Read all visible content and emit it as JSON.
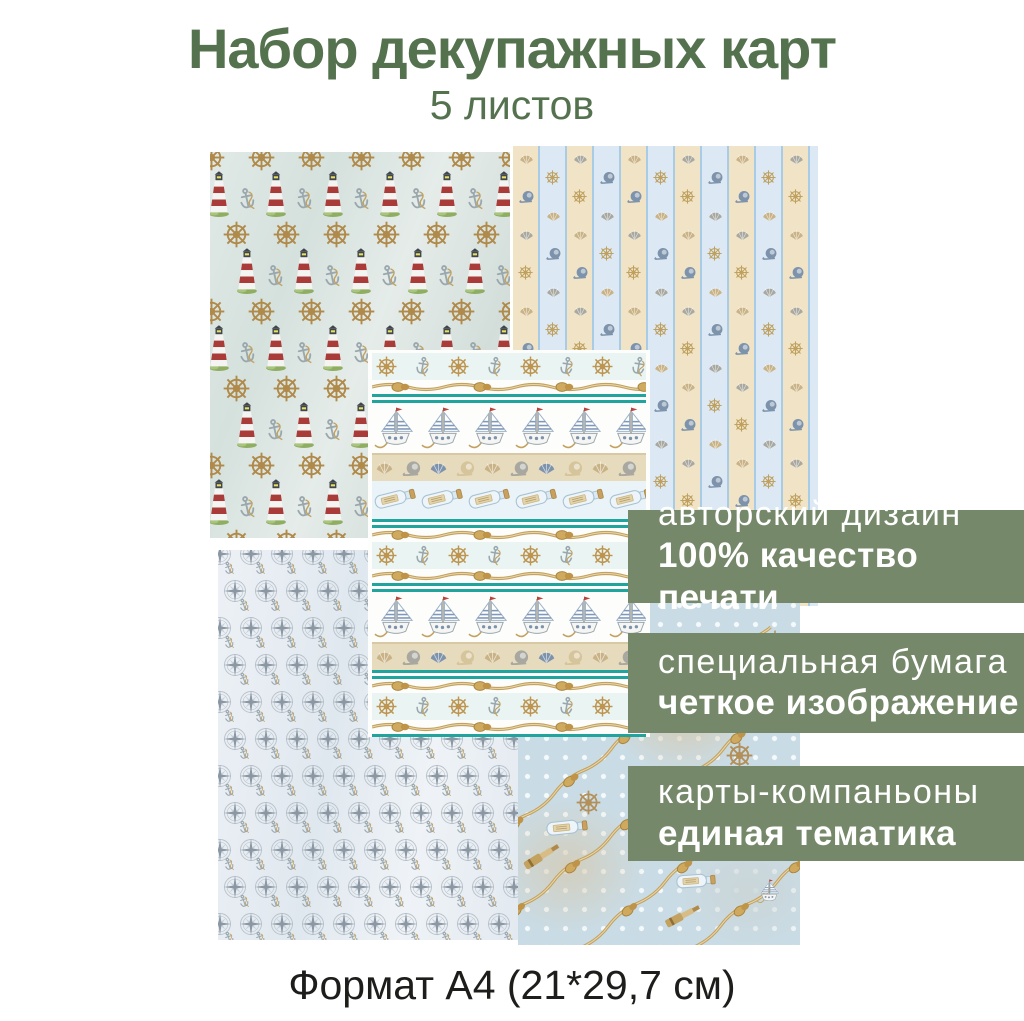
{
  "title": "Набор декупажных карт",
  "subtitle": "5 листов",
  "footer": "Формат А4 (21*29,7 см)",
  "badges": [
    {
      "line1": "авторский дизайн",
      "line2": "100% качество печати"
    },
    {
      "line1": "специальная бумага",
      "line2": "четкое изображение"
    },
    {
      "line1": "карты-компаньоны",
      "line2": "единая тематика"
    }
  ],
  "sheets": [
    {
      "name": "lighthouses-and-wheels",
      "motifs": "lighthouses, ship wheels, anchors on pale blue-green"
    },
    {
      "name": "striped-shells",
      "motifs": "vertical cream and blue stripes with seashells and small wheels"
    },
    {
      "name": "nautical-borders",
      "motifs": "horizontal borders: wheels, anchors, ropes, sailboats, shells, message bottles, teal stripes"
    },
    {
      "name": "compass-roses",
      "motifs": "compass roses with small anchors on pale blue"
    },
    {
      "name": "polka-dot-ropes",
      "motifs": "polka dots with diagonal ropes, telescopes, bottles, wheels, sailboats"
    }
  ],
  "colors": {
    "title_green": "#55724f",
    "badge_green": "#76886a",
    "badge_text": "#ffffff",
    "teal": "#21a39e",
    "rope_gold": "#c3a15f",
    "wheel_gold": "#b08a4a",
    "lighthouse_red": "#a93c38",
    "steel_blue": "#7d93ab",
    "shell_tan": "#c9b285",
    "shell_gray": "#a8a8a0",
    "compass_gray": "#8b97a3",
    "footer_text": "#1d1d1b"
  }
}
